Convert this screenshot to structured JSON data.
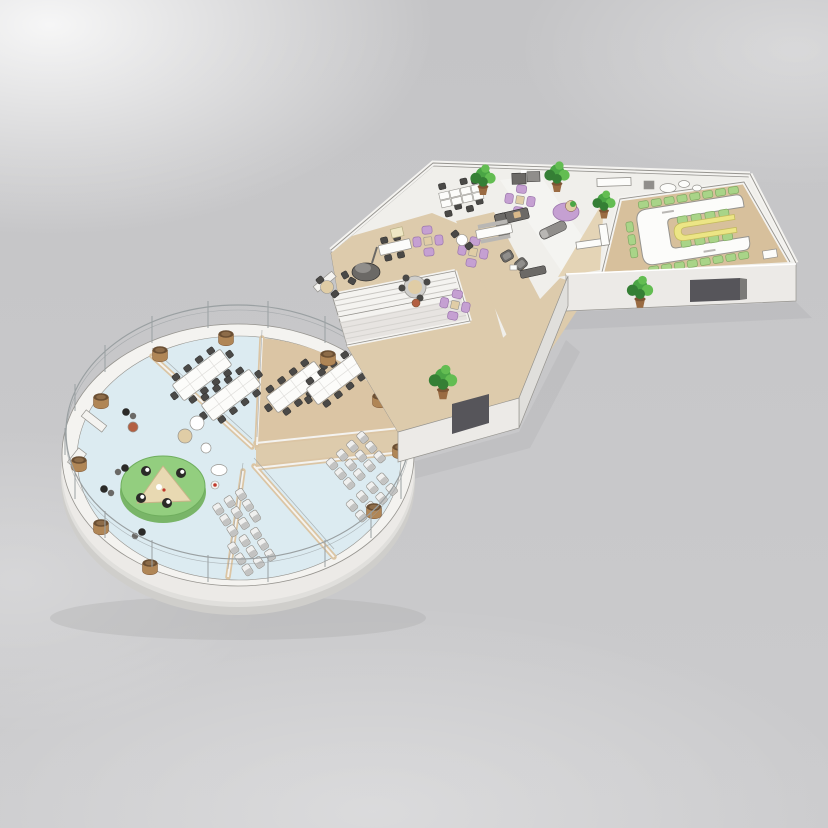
{
  "scene": {
    "title": "3D isometric cutaway render of an office floor plan",
    "description": "Hand-sketched architectural rendering: a circular glass-railed pavilion divided into pie-slice rooms, linked by an open staircase and tan walkway to an angular open-plan office wing that ends in a conference room with a white U-shaped table and a yellow inner U-table.",
    "areas": {
      "circular_pavilion": {
        "label": "Circular pavilion",
        "rooms": [
          {
            "name": "conference-room-north",
            "floor": "light blue",
            "furniture": "2 long modular tables with dark chairs"
          },
          {
            "name": "conference-room-northeast",
            "floor": "tan",
            "furniture": "2 long modular tables with dark chairs"
          },
          {
            "name": "training-seating-east",
            "floor": "light blue",
            "furniture": "rows of silver chairs"
          },
          {
            "name": "training-seating-south",
            "floor": "light blue",
            "furniture": "rows of silver chairs"
          },
          {
            "name": "lounge-west",
            "floor": "light blue",
            "furniture": "round green platform with triangular table, black-and-white stools, bean bags, small round tables"
          }
        ],
        "perimeter": "white drum wall with glass railing posts and wooden planters"
      },
      "connector": {
        "label": "Staircase connector",
        "features": [
          "open stairwell with white balustrades",
          "tan walkway",
          "potted plant"
        ]
      },
      "office_wing": {
        "label": "Open office wing",
        "features": [
          "white desk cluster",
          "lilac four-chair clusters",
          "gray sofas and armchairs",
          "kitchenette cabinets and white counter",
          "round tables with stools",
          "dome lamp table",
          "tan diagonal walkways",
          "potted plants"
        ]
      },
      "conference_room": {
        "label": "U-table conference room",
        "features": [
          "white U-shaped table",
          "yellow inner U-shaped table",
          "green chairs",
          "tan floor",
          "white side cabinet"
        ]
      }
    }
  },
  "palette": {
    "ground": "#c8c8ca",
    "shadow": "#a9a9ab",
    "wall_white": "#f4f3f0",
    "wall_light": "#eceae7",
    "wall_mid": "#e0dfdc",
    "wall_dark": "#cfcecb",
    "line": "#96948f",
    "glass": "#9aa0a2",
    "white": "#ffffff",
    "floor_office": "#f0efeb",
    "floor_blue": "#dcebf1",
    "slice_tan": "#dbc5a4",
    "floor_tan": "#d7c09c",
    "floor_tan_light": "#e4d4b6",
    "walkway_tan": "#ddcbac",
    "opening": "#56555a",
    "jamb": "#7b7a78",
    "table_white": "#fcfcfa",
    "table_yellow": "#ece585",
    "table_yellow_line": "#c4bb5e",
    "chair_dark": "#4a4947",
    "chair_dark_line": "#2f2e2d",
    "chair_green": "#a9d488",
    "chair_green_line": "#7fa862",
    "silver": "#c3c3c2",
    "silver_light": "#f0f0ef",
    "purple": "#c5a0d2",
    "purple_line": "#9c77ad",
    "sofa_gray": "#6b6966",
    "sofa_gray_light": "#908e8b",
    "bench_gray": "#b9b7b4",
    "plant_green": "#4aa545",
    "plant_dark": "#357f35",
    "plant_light": "#63bd52",
    "pot_brown": "#9a6b42",
    "pot_rim": "#7c5433",
    "planter_brown": "#b08656",
    "planter_top": "#6b4f33",
    "planter_inner": "#8d6c49",
    "platform_green": "#93ce7f",
    "platform_side": "#79b568",
    "platform_line": "#6fae5e",
    "tri_tan": "#e8d9b2",
    "tri_line": "#c8b488",
    "wood_tan": "#e0cda6",
    "stool_black": "#2b2a28",
    "red_stool": "#b35f41",
    "red_bright": "#c0392b",
    "cream": "#eee7c4",
    "cream_line": "#b5ad82",
    "tread_line": "#c9c7c3",
    "stair_shade": "#dddbd7",
    "tan_pillow": "#d9b98a"
  }
}
